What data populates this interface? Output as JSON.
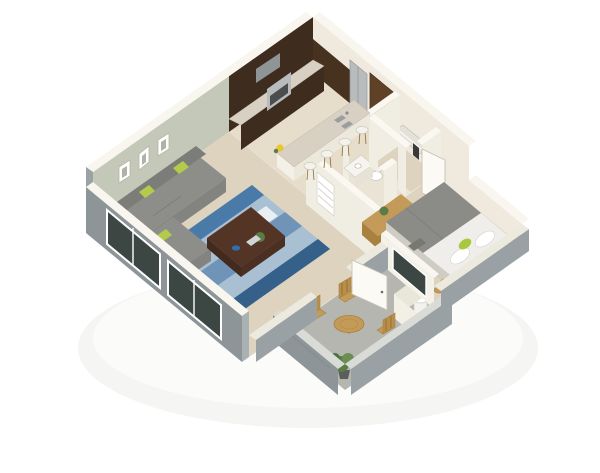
{
  "scene": {
    "kind": "3d-isometric-floor-plan-render",
    "subject": "one-bedroom apartment cutaway dollhouse view",
    "background": "#ffffff",
    "rooms": [
      {
        "name": "living-room",
        "furniture": [
          "gray sectional sofa",
          "lime pillows",
          "blue patterned area rug",
          "dark wood coffee table",
          "three wall frames",
          "sliding glass windows"
        ]
      },
      {
        "name": "kitchen",
        "furniture": [
          "dark wood cabinets",
          "granite counters",
          "stainless oven and hood",
          "stainless refrigerator",
          "breakfast bar with double sink",
          "four white bar stools",
          "yellow flowers"
        ]
      },
      {
        "name": "hallway",
        "furniture": [
          "brown entry door",
          "white linen shelves"
        ]
      },
      {
        "name": "bathroom",
        "furniture": [
          "toilet",
          "white vanity with basin"
        ]
      },
      {
        "name": "walk-in-closet",
        "furniture": [
          "wire shelving",
          "hanging clothes"
        ]
      },
      {
        "name": "bedroom",
        "furniture": [
          "queen bed with gray duvet",
          "white pillows",
          "lime accent pillow",
          "oak dresser with plant",
          "two amber ball lamps",
          "round side stool",
          "white door"
        ]
      },
      {
        "name": "patio",
        "furniture": [
          "round wood table",
          "three slatted wood chairs",
          "potted shrub",
          "water heater closet",
          "white patio door"
        ]
      }
    ]
  },
  "palette": {
    "wallTop": "#f8f6ef",
    "cream": "#efeadd",
    "sage": "#c4c8b8",
    "exteriorGray": "#99a1a4",
    "exteriorGrayDark": "#8d9599",
    "carpet": "#ddd3be",
    "tile": "#e7ddcb",
    "bathTile": "#eae4d6",
    "patioFloor": "#b5b6b0",
    "patioWallTop": "#d9dcd6",
    "cabinetDark": "#3e2c1f",
    "granite": "#d8d1c3",
    "stainless": "#b9bcbd",
    "doorBrown": "#5f4128",
    "rugBase": "#a9bfd2",
    "rugBlue": "#4a7aa8",
    "rugBlueDark": "#35608a",
    "rugBlueMid": "#6f94b8",
    "sofa": "#8d8e8a",
    "sofaDark": "#7c7d79",
    "lime": "#b2cb4a",
    "tableWood": "#533425",
    "oak": "#c49a58",
    "oakDark": "#a8813f",
    "duvet": "#8b8b87",
    "sheets": "#f0eeea",
    "amber": "#e39b16",
    "glass": "#3c4642",
    "plantGreen": "#5a7d46"
  }
}
